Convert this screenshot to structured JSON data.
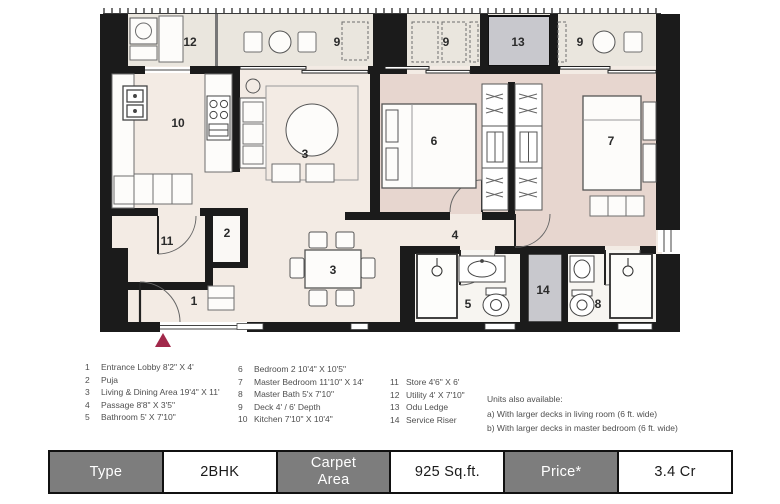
{
  "plan": {
    "rooms": [
      {
        "id": "12",
        "label": "12",
        "x": 190,
        "y": 46
      },
      {
        "id": "9a",
        "label": "9",
        "x": 337,
        "y": 46
      },
      {
        "id": "9b",
        "label": "9",
        "x": 446,
        "y": 46
      },
      {
        "id": "13",
        "label": "13",
        "x": 518,
        "y": 46
      },
      {
        "id": "9c",
        "label": "9",
        "x": 580,
        "y": 46
      },
      {
        "id": "10",
        "label": "10",
        "x": 178,
        "y": 127
      },
      {
        "id": "3-living",
        "label": "3",
        "x": 305,
        "y": 158
      },
      {
        "id": "6",
        "label": "6",
        "x": 434,
        "y": 145
      },
      {
        "id": "7",
        "label": "7",
        "x": 611,
        "y": 145
      },
      {
        "id": "11",
        "label": "11",
        "x": 167,
        "y": 245
      },
      {
        "id": "2",
        "label": "2",
        "x": 227,
        "y": 237
      },
      {
        "id": "4",
        "label": "4",
        "x": 455,
        "y": 239
      },
      {
        "id": "1",
        "label": "1",
        "x": 194,
        "y": 305
      },
      {
        "id": "3-dining",
        "label": "3",
        "x": 333,
        "y": 274
      },
      {
        "id": "5",
        "label": "5",
        "x": 468,
        "y": 308
      },
      {
        "id": "14",
        "label": "14",
        "x": 543,
        "y": 294
      },
      {
        "id": "8",
        "label": "8",
        "x": 598,
        "y": 308
      }
    ]
  },
  "legend": {
    "columns": [
      {
        "items": [
          {
            "num": "1",
            "text": "Entrance Lobby  8'2\" X 4'"
          },
          {
            "num": "2",
            "text": "Puja"
          },
          {
            "num": "3",
            "text": "Living & Dining Area  19'4\" X 11'"
          },
          {
            "num": "4",
            "text": "Passage  8'8\" X 3'5\""
          },
          {
            "num": "5",
            "text": "Bathroom  5' X 7'10\""
          }
        ]
      },
      {
        "items": [
          {
            "num": "6",
            "text": "Bedroom 2  10'4\" X 10'5\""
          },
          {
            "num": "7",
            "text": "Master Bedroom  11'10\" X 14'"
          },
          {
            "num": "8",
            "text": "Master Bath  5'x 7'10\""
          },
          {
            "num": "9",
            "text": "Deck  4' / 6' Depth"
          },
          {
            "num": "10",
            "text": "Kitchen  7'10\" X 10'4\""
          }
        ]
      },
      {
        "items": [
          {
            "num": "11",
            "text": "Store  4'6\" X 6'"
          },
          {
            "num": "12",
            "text": "Utility  4' X 7'10\""
          },
          {
            "num": "13",
            "text": "Odu Ledge"
          },
          {
            "num": "14",
            "text": "Service Riser"
          }
        ]
      }
    ],
    "notes": {
      "title": "Units also available:",
      "lines": [
        "a) With larger decks in living room (6 ft. wide)",
        "b) With larger decks in master bedroom (6 ft. wide)"
      ]
    }
  },
  "summary_table": {
    "cells": [
      {
        "label": "Type",
        "style": "header"
      },
      {
        "label": "2BHK",
        "style": "value"
      },
      {
        "label": "Carpet\nArea",
        "style": "header"
      },
      {
        "label": "925 Sq.ft.",
        "style": "value"
      },
      {
        "label": "Price*",
        "style": "header"
      },
      {
        "label": "3.4 Cr",
        "style": "value"
      }
    ]
  },
  "colors": {
    "wall": "#1b1b1b",
    "floor_main": "#f3ebe4",
    "floor_bedroom": "#e7d6cf",
    "floor_deck": "#eae6de",
    "floor_bath": "#f7f5f1",
    "gray_box": "#c8c8cd",
    "entry_red": "#a1284a",
    "table_gray": "#7d7d7d",
    "legend_text": "#4f4f4f"
  }
}
